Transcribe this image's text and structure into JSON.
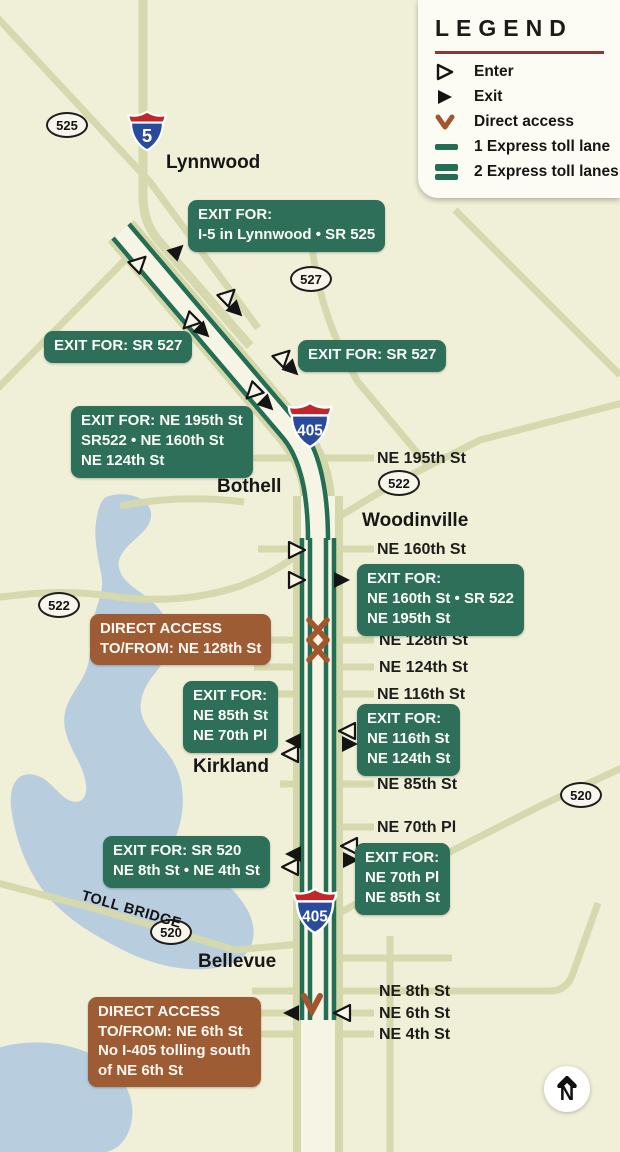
{
  "legend": {
    "title": "LEGEND",
    "items": [
      {
        "label": "Enter",
        "icon": "enter-arrow"
      },
      {
        "label": "Exit",
        "icon": "exit-arrow"
      },
      {
        "label": "Direct access",
        "icon": "direct-access-chevron"
      },
      {
        "label": "1 Express toll lane",
        "icon": "one-lane-bar"
      },
      {
        "label": "2 Express toll lanes",
        "icon": "two-lane-bars"
      }
    ]
  },
  "shields": {
    "i5": "5",
    "i405_north": "405",
    "i405_south": "405",
    "sr525": "525",
    "sr527": "527",
    "sr522_east": "522",
    "sr522_west": "522",
    "sr520_east": "520",
    "sr520_bridge": "520"
  },
  "cities": {
    "lynnwood": "Lynnwood",
    "bothell": "Bothell",
    "woodinville": "Woodinville",
    "kirkland": "Kirkland",
    "bellevue": "Bellevue"
  },
  "streets": {
    "ne195": "NE 195th St",
    "ne160": "NE 160th St",
    "ne128": "NE 128th St",
    "ne124": "NE 124th St",
    "ne116": "NE 116th St",
    "ne85": "NE 85th St",
    "ne70": "NE 70th Pl",
    "ne8": "NE 8th St",
    "ne6": "NE 6th St",
    "ne4": "NE 4th St"
  },
  "callouts": {
    "exit_lynnwood": "EXIT FOR:\nI-5 in Lynnwood • SR 525",
    "exit_sr527_left": "EXIT FOR: SR 527",
    "exit_sr527_right": "EXIT FOR: SR 527",
    "exit_ne195_group": "EXIT FOR: NE 195th St\nSR522 • NE 160th St\nNE 124th St",
    "exit_ne160_group": "EXIT FOR:\nNE 160th St • SR 522\nNE 195th St",
    "exit_ne85_group": "EXIT FOR:\nNE 85th St\nNE 70th Pl",
    "exit_ne116_group": "EXIT FOR:\nNE 116th St\nNE 124th St",
    "exit_sr520_group": "EXIT FOR: SR 520\nNE 8th St • NE 4th St",
    "exit_ne70_group": "EXIT FOR:\nNE 70th Pl\nNE 85th St",
    "direct_ne128": "DIRECT ACCESS\nTO/FROM: NE 128th St",
    "direct_ne6": "DIRECT ACCESS\nTO/FROM: NE 6th St\nNo I-405 tolling south\nof NE 6th St"
  },
  "labels": {
    "toll_bridge": "TOLL BRIDGE",
    "north": "N"
  },
  "colors": {
    "toll_lane_green": "#256e56",
    "callout_green": "#2e6f59",
    "direct_access_brown": "#9e5c34",
    "water_blue": "#b8cedf",
    "road_olive": "#d6d9ad",
    "interstate_blue": "#2a4b9b",
    "interstate_red": "#c0272d",
    "legend_rule_red": "#8a3a32"
  }
}
